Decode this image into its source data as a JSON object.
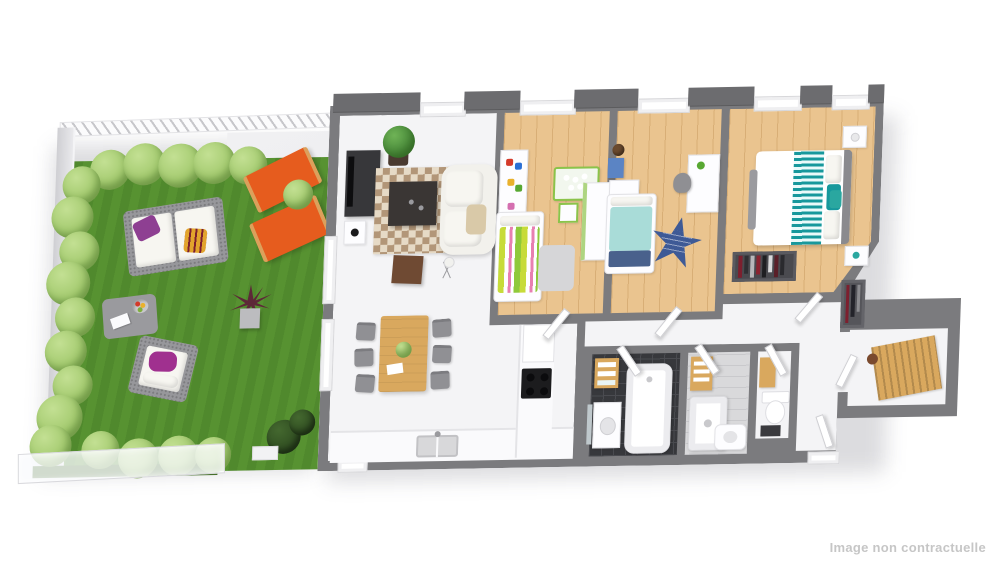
{
  "image_type": "3d-isometric-floor-plan-render",
  "watermark": {
    "text": "Image non contractuelle"
  },
  "palette": {
    "wall": "#7b7b7e",
    "wall-dark": "#6c6c6f",
    "floor": "#f4f4f6",
    "wood": "#eac48f",
    "wood-line": "#d8ae76",
    "tile-dark": "#37383c",
    "tile-light": "#d9d9db",
    "grass": "#579231",
    "hedge": "#9cc566",
    "hedge-dark": "#2e4b20",
    "terrace": "#e9e9ec",
    "orange": "#e65c1e",
    "wicker": "#97979b",
    "teal": "#17989c",
    "teal-light": "#a9dcd8",
    "navy": "#49618c",
    "star-blue": "#3e5a96",
    "purple": "#8e3f92",
    "magenta": "#a0308f",
    "yellow": "#e2a42c",
    "wood-furn": "#d9a85e",
    "white-furn": "#fdfdff",
    "dracaena": "#5d2838",
    "watermark": "#c6c6c6"
  },
  "garden": {
    "name": "garden-terrace",
    "features": [
      "lawn",
      "hedge-top-row",
      "hedge-left-row",
      "hedge-bottom-row",
      "privacy-fence-hatched",
      "side-fence",
      "glass-balustrade",
      "concrete-terrace",
      "dark-bushes",
      "white-planter"
    ],
    "furniture": [
      "outdoor-wicker-sofa",
      "white-cushions",
      "purple-pillow",
      "yellow-striped-pillow",
      "wicker-armchair",
      "magenta-pillow",
      "wicker-coffee-table",
      "fruit-bowl",
      "white-book",
      "orange-deck-chair-1",
      "orange-deck-chair-2",
      "green-shrub",
      "dracaena-pot-plant"
    ]
  },
  "rooms": [
    {
      "id": "living-dining-kitchen",
      "floor": "white",
      "furniture": [
        "tv-sideboard",
        "tv",
        "metal-side-table",
        "potted-plant",
        "patchwork-rug",
        "dark-coffee-table",
        "white-sofa",
        "throw-blanket",
        "brown-side-table",
        "tripod-floor-lamp",
        "dining-table",
        "plant-centerpiece",
        "white-paper",
        "dining-chair-x6",
        "kitchen-counter",
        "double-sink",
        "tall-cabinet",
        "cooktop"
      ]
    },
    {
      "id": "kids-bedroom-1",
      "floor": "wood",
      "furniture": [
        "toy-shelf",
        "toys",
        "teddy-bear",
        "striped-bed",
        "pillow",
        "play-table",
        "kids-chair",
        "wardrobe",
        "gray-rug",
        "door"
      ]
    },
    {
      "id": "kids-bedroom-2",
      "floor": "wood",
      "furniture": [
        "basketball",
        "wall-cubes",
        "nightstand",
        "teal-bed",
        "navy-blanket",
        "star-rug",
        "desk",
        "desk-chair",
        "desk-plant",
        "door"
      ]
    },
    {
      "id": "master-bedroom",
      "floor": "wood",
      "furniture": [
        "double-bed",
        "teal-patterned-runner",
        "teal-cushions",
        "white-pillows",
        "headboard",
        "round-rug",
        "bench",
        "nightstand-x2",
        "open-closet",
        "hanging-clothes",
        "door"
      ]
    },
    {
      "id": "bathroom",
      "floor": "dark-tile",
      "furniture": [
        "towel-shelf",
        "bathtub",
        "vanity-sink",
        "mirror",
        "door"
      ]
    },
    {
      "id": "shower-room",
      "floor": "light-tile",
      "furniture": [
        "towel-ladder",
        "shower-tray",
        "washbasin",
        "door"
      ]
    },
    {
      "id": "wc",
      "floor": "white",
      "furniture": [
        "toilet",
        "wood-vanity",
        "dark-mat",
        "door"
      ]
    },
    {
      "id": "hallway",
      "floor": "white",
      "furniture": [
        "doors"
      ]
    },
    {
      "id": "entrance",
      "floor": "white",
      "furniture": [
        "coat-rack",
        "hanging-coats",
        "slatted-wood-bench",
        "bolster-pillow",
        "front-door"
      ]
    }
  ]
}
